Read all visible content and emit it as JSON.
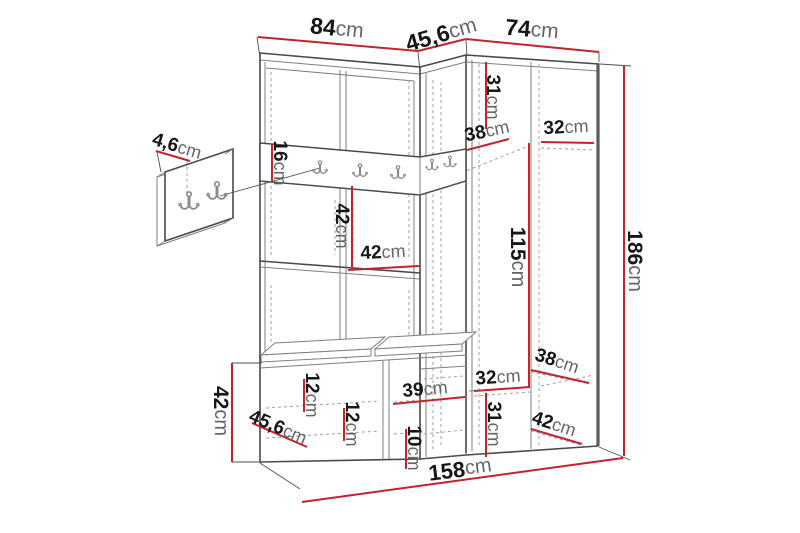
{
  "diagram": {
    "description_unit": "cm",
    "colors": {
      "dimension_red": "#c0252c",
      "line_dark": "#4a4a4a",
      "line_light": "#8a8a8a",
      "background": "#ffffff"
    },
    "dimensions": [
      {
        "id": "top-width-left",
        "value": "84",
        "unit": "cm",
        "line": [
          258,
          37,
          418,
          51
        ],
        "label": {
          "x": 337,
          "y": 28,
          "rot": 6,
          "size": 23
        }
      },
      {
        "id": "top-width-corner",
        "value": "45,6",
        "unit": "cm",
        "line": [
          418,
          51,
          466,
          39
        ],
        "label": {
          "x": 441,
          "y": 34,
          "rot": -16,
          "size": 23
        }
      },
      {
        "id": "top-width-right",
        "value": "74",
        "unit": "cm",
        "line": [
          466,
          39,
          599,
          52
        ],
        "label": {
          "x": 532,
          "y": 29,
          "rot": 5,
          "size": 23
        }
      },
      {
        "id": "upper-shelf-height",
        "value": "31",
        "unit": "cm",
        "line": [
          486,
          62,
          486,
          129
        ],
        "label": {
          "x": 493,
          "y": 97,
          "rot": 90,
          "size": 19
        }
      },
      {
        "id": "upper-shelf-depth",
        "value": "38",
        "unit": "cm",
        "line": [
          467,
          150,
          509,
          139
        ],
        "label": {
          "x": 487,
          "y": 131,
          "rot": -12,
          "size": 19
        }
      },
      {
        "id": "upper-shelf-width",
        "value": "32",
        "unit": "cm",
        "line": [
          541,
          142,
          594,
          143
        ],
        "label": {
          "x": 566,
          "y": 127,
          "rot": -3,
          "size": 19
        }
      },
      {
        "id": "hook-rail-height",
        "value": "16",
        "unit": "cm",
        "line": [
          272,
          144,
          272,
          181
        ],
        "label": {
          "x": 280,
          "y": 163,
          "rot": 90,
          "size": 19
        }
      },
      {
        "id": "panel-thickness",
        "value": "4,6",
        "unit": "cm",
        "line": [
          156,
          151,
          190,
          161
        ],
        "label": {
          "x": 177,
          "y": 146,
          "rot": 17,
          "size": 19
        }
      },
      {
        "id": "open-section-height",
        "value": "42",
        "unit": "cm",
        "line": [
          352,
          186,
          352,
          268
        ],
        "label": {
          "x": 342,
          "y": 226,
          "rot": 90,
          "size": 19
        }
      },
      {
        "id": "open-section-width",
        "value": "42",
        "unit": "cm",
        "line": [
          348,
          270,
          419,
          266
        ],
        "label": {
          "x": 383,
          "y": 252,
          "rot": -3,
          "size": 19
        }
      },
      {
        "id": "wardrobe-inner-height",
        "value": "115",
        "unit": "cm",
        "line": [
          529,
          143,
          529,
          388
        ],
        "label": {
          "x": 518,
          "y": 257,
          "rot": 90,
          "size": 21
        }
      },
      {
        "id": "total-height",
        "value": "186",
        "unit": "cm",
        "line": [
          624,
          66,
          624,
          456
        ],
        "label": {
          "x": 635,
          "y": 261,
          "rot": 90,
          "size": 21
        }
      },
      {
        "id": "lower-shelf-depth",
        "value": "38",
        "unit": "cm",
        "line": [
          531,
          370,
          589,
          383
        ],
        "label": {
          "x": 557,
          "y": 361,
          "rot": 18,
          "size": 19
        }
      },
      {
        "id": "lower-shelf-width",
        "value": "32",
        "unit": "cm",
        "line": [
          474,
          391,
          530,
          387
        ],
        "label": {
          "x": 498,
          "y": 377,
          "rot": -4,
          "size": 19
        }
      },
      {
        "id": "lower-bay-height",
        "value": "31",
        "unit": "cm",
        "line": [
          486,
          393,
          486,
          457
        ],
        "label": {
          "x": 494,
          "y": 424,
          "rot": 90,
          "size": 19
        }
      },
      {
        "id": "base-depth-right",
        "value": "42",
        "unit": "cm",
        "line": [
          531,
          429,
          582,
          444
        ],
        "label": {
          "x": 554,
          "y": 424,
          "rot": 18,
          "size": 19
        }
      },
      {
        "id": "bench-top-height",
        "value": "12",
        "unit": "cm",
        "line": [
          304,
          379,
          304,
          412
        ],
        "label": {
          "x": 312,
          "y": 395,
          "rot": 90,
          "size": 19
        }
      },
      {
        "id": "bench-drawer-height",
        "value": "12",
        "unit": "cm",
        "line": [
          344,
          408,
          344,
          441
        ],
        "label": {
          "x": 352,
          "y": 424,
          "rot": 90,
          "size": 19
        }
      },
      {
        "id": "bench-bay-width",
        "value": "39",
        "unit": "cm",
        "line": [
          393,
          404,
          465,
          397
        ],
        "label": {
          "x": 425,
          "y": 389,
          "rot": -5,
          "size": 19
        }
      },
      {
        "id": "shoe-gap-height",
        "value": "10",
        "unit": "cm",
        "line": [
          406,
          429,
          406,
          469
        ],
        "label": {
          "x": 414,
          "y": 448,
          "rot": 90,
          "size": 19
        }
      },
      {
        "id": "bench-depth",
        "value": "45,6",
        "unit": "cm",
        "line": [
          252,
          423,
          307,
          447
        ],
        "label": {
          "x": 278,
          "y": 427,
          "rot": 23,
          "size": 19
        }
      },
      {
        "id": "bench-height",
        "value": "42",
        "unit": "cm",
        "line": [
          232,
          363,
          232,
          462
        ],
        "label": {
          "x": 221,
          "y": 411,
          "rot": 90,
          "size": 21
        }
      },
      {
        "id": "total-width",
        "value": "158",
        "unit": "cm",
        "line": [
          302,
          502,
          623,
          458
        ],
        "label": {
          "x": 460,
          "y": 469,
          "rot": -7,
          "size": 22
        }
      }
    ]
  }
}
